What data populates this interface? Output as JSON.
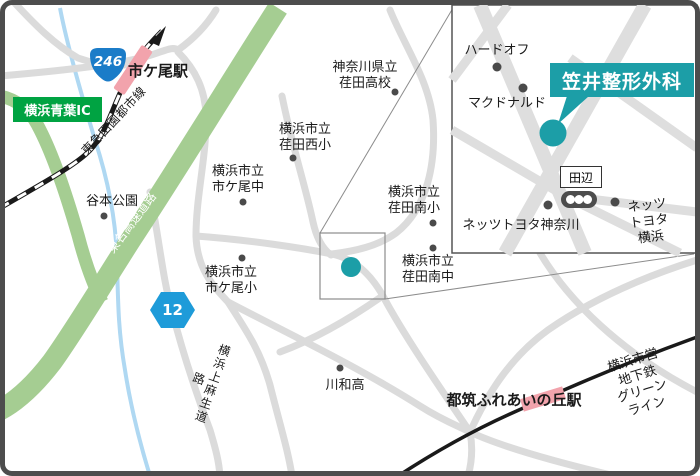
{
  "title": "笠井整形外科 案内地図",
  "main_map": {
    "badges": {
      "route246": "246",
      "route12": "12",
      "interchange": "横浜青葉IC"
    },
    "stations": {
      "ichigao": "市ケ尾駅",
      "tsuzuki": "都筑ふれあいの丘駅"
    },
    "lines": {
      "tokyu": "東急田園都市線",
      "tomei": "東名高速道路",
      "kamiasao": "横浜上麻生道路",
      "greenline": "横浜市営地下鉄\nグリーンライン"
    },
    "places": {
      "yamoto_park": "谷本公園",
      "ichigao_jhs": "横浜市立\n市ケ尾中",
      "ichigao_es": "横浜市立\n市ケ尾小",
      "eda_hs": "神奈川県立\n荏田高校",
      "eda_west_es": "横浜市立\n荏田西小",
      "eda_south_es": "横浜市立\n荏田南小",
      "eda_south_jhs": "横浜市立\n荏田南中",
      "kawawa_hs": "川和高"
    }
  },
  "inset": {
    "clinic": "笠井整形外科",
    "hardoff": "ハードオフ",
    "mcdonalds": "マクドナルド",
    "intersection": "田辺",
    "netz_kanagawa": "ネッツトヨタ神奈川",
    "netz_yokohama": "ネッツトヨタ横浜"
  },
  "colors": {
    "accent_teal": "#1C9EA7",
    "road_gray": "#DBDBDB",
    "inset_road": "#DEDEDE",
    "highway_green": "#A5CD92",
    "ic_green": "#00A342",
    "rail_pink": "#F2A3AC",
    "river_blue": "#AFD8F2",
    "route246_blue": "#1B7CC8",
    "route12_blue": "#1E9BD9",
    "rail_black": "#1A1A1A",
    "frame_gray": "#4D4D4D",
    "label_ink": "#1A1A1A",
    "leader_gray": "#8C8C8C"
  }
}
